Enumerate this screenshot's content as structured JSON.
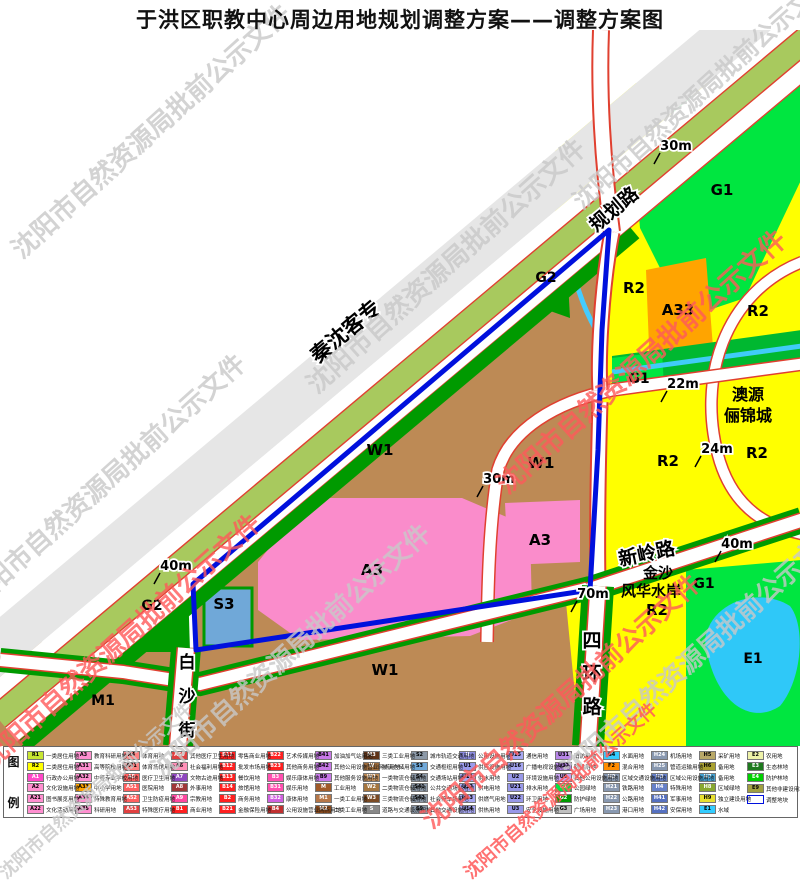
{
  "title": "于洪区职教中心周边用地规划调整方案——调整方案图",
  "watermark": {
    "text": "沈阳市自然资源局批前公示文件",
    "gray_color": "#c9c9c9",
    "red_color": "#ff5a5a",
    "instances": [
      {
        "x": 150,
        "y": 130,
        "color": "#c9c9c9",
        "size": 26,
        "opacity": 0.8
      },
      {
        "x": 445,
        "y": 265,
        "color": "#c9c9c9",
        "size": 26,
        "opacity": 0.8
      },
      {
        "x": 105,
        "y": 480,
        "color": "#c9c9c9",
        "size": 26,
        "opacity": 0.8
      },
      {
        "x": 290,
        "y": 650,
        "color": "#c9c9c9",
        "size": 26,
        "opacity": 0.8
      },
      {
        "x": 700,
        "y": 650,
        "color": "#c9c9c9",
        "size": 26,
        "opacity": 0.8
      },
      {
        "x": 700,
        "y": 90,
        "color": "#c9c9c9",
        "size": 24,
        "opacity": 0.8
      },
      {
        "x": 95,
        "y": 790,
        "color": "#c9c9c9",
        "size": 18,
        "opacity": 0.8
      },
      {
        "x": 640,
        "y": 360,
        "color": "#ff5a5a",
        "size": 27,
        "opacity": 0.8
      },
      {
        "x": 120,
        "y": 640,
        "color": "#ff5a5a",
        "size": 26,
        "opacity": 0.8
      },
      {
        "x": 560,
        "y": 700,
        "color": "#ff5a5a",
        "size": 26,
        "opacity": 0.8
      },
      {
        "x": 560,
        "y": 790,
        "color": "#ff5a5a",
        "size": 18,
        "opacity": 0.85
      }
    ]
  },
  "map": {
    "zone_colors": {
      "R2": "#ffff00",
      "W1": "#bd8a55",
      "A3": "#fa8ccb",
      "A33": "#ffa400",
      "G1": "#00e640",
      "G2": "#009a00",
      "S3": "#70a8d8",
      "E1": "#2fc8f8",
      "corridor_band": "#a8c95e",
      "road_edge": "#e04030",
      "boundary": "#0010dd"
    },
    "road_labels": [
      {
        "text": "规划路",
        "x": 618,
        "y": 184,
        "size": 19,
        "rot": -40,
        "outline": true
      },
      {
        "text": "秦沈客专",
        "x": 350,
        "y": 307,
        "size": 21,
        "rot": -40,
        "outline": true
      },
      {
        "text": "新岭路",
        "x": 648,
        "y": 530,
        "size": 19,
        "rot": -12,
        "outline": true
      },
      {
        "text": "四环路",
        "x": 592,
        "y": 617,
        "size": 19,
        "rot": 0,
        "outline": true,
        "vertical": true,
        "step": 33
      },
      {
        "text": "白沙街",
        "x": 187,
        "y": 638,
        "size": 17,
        "rot": 0,
        "outline": true,
        "vertical": true,
        "step": 34
      }
    ],
    "zone_labels": [
      {
        "text": "G1",
        "x": 722,
        "y": 165,
        "size": 15
      },
      {
        "text": "R2",
        "x": 634,
        "y": 263,
        "size": 15
      },
      {
        "text": "A33",
        "x": 678,
        "y": 285,
        "size": 15
      },
      {
        "text": "R2",
        "x": 758,
        "y": 286,
        "size": 15
      },
      {
        "text": "G2",
        "x": 546,
        "y": 252,
        "size": 14
      },
      {
        "text": "G1",
        "x": 639,
        "y": 353,
        "size": 14
      },
      {
        "text": "R2",
        "x": 668,
        "y": 436,
        "size": 15
      },
      {
        "text": "R2",
        "x": 757,
        "y": 428,
        "size": 15
      },
      {
        "text": "W1",
        "x": 380,
        "y": 425,
        "size": 15
      },
      {
        "text": "W1",
        "x": 541,
        "y": 438,
        "size": 15
      },
      {
        "text": "A3",
        "x": 372,
        "y": 545,
        "size": 15
      },
      {
        "text": "A3",
        "x": 540,
        "y": 515,
        "size": 15
      },
      {
        "text": "G2",
        "x": 152,
        "y": 580,
        "size": 14
      },
      {
        "text": "S3",
        "x": 224,
        "y": 579,
        "size": 15
      },
      {
        "text": "W1",
        "x": 385,
        "y": 645,
        "size": 15
      },
      {
        "text": "M1",
        "x": 103,
        "y": 675,
        "size": 14
      },
      {
        "text": "G1",
        "x": 704,
        "y": 558,
        "size": 14
      },
      {
        "text": "E1",
        "x": 753,
        "y": 633,
        "size": 14
      },
      {
        "text": "澳源",
        "x": 748,
        "y": 370,
        "size": 16
      },
      {
        "text": "俪锦城",
        "x": 748,
        "y": 391,
        "size": 16
      },
      {
        "text": "金沙",
        "x": 658,
        "y": 548,
        "size": 15
      },
      {
        "text": "风华水岸",
        "x": 651,
        "y": 566,
        "size": 15
      },
      {
        "text": "R2",
        "x": 657,
        "y": 585,
        "size": 15
      }
    ],
    "dimensions": [
      {
        "text": "30m",
        "x": 676,
        "y": 120
      },
      {
        "text": "22m",
        "x": 683,
        "y": 358
      },
      {
        "text": "24m",
        "x": 717,
        "y": 423
      },
      {
        "text": "40m",
        "x": 737,
        "y": 518
      },
      {
        "text": "70m",
        "x": 593,
        "y": 568
      },
      {
        "text": "30m",
        "x": 499,
        "y": 453
      },
      {
        "text": "40m",
        "x": 176,
        "y": 540
      }
    ]
  },
  "legend": {
    "header_chars": [
      "图",
      "例"
    ],
    "columns": [
      [
        {
          "code": "R1",
          "label": "一类居住用地",
          "color": "#c8e632"
        },
        {
          "code": "R2",
          "label": "二类居住用地",
          "color": "#ffff00"
        },
        {
          "code": "A1",
          "label": "行政办公用地",
          "color": "#ff48c8"
        },
        {
          "code": "A2",
          "label": "文化设施用地",
          "color": "#ff8fd0"
        },
        {
          "code": "A21",
          "label": "图书展览用地",
          "color": "#ff8fd0"
        },
        {
          "code": "A22",
          "label": "文化活动用地",
          "color": "#ff8fd0"
        }
      ],
      [
        {
          "code": "A3",
          "label": "教育科研用地",
          "color": "#ff8fd0"
        },
        {
          "code": "A31",
          "label": "高等院校用地",
          "color": "#ff8fd0"
        },
        {
          "code": "A32",
          "label": "中等专业学校用地",
          "color": "#ff8fd0"
        },
        {
          "code": "A33",
          "label": "中小学用地",
          "color": "#ffa400"
        },
        {
          "code": "A34",
          "label": "特殊教育用地",
          "color": "#ff8fd0"
        },
        {
          "code": "A35",
          "label": "科研用地",
          "color": "#ff8fd0"
        }
      ],
      [
        {
          "code": "A4",
          "label": "体育用地",
          "color": "#ff8080"
        },
        {
          "code": "A41",
          "label": "体育场馆用地",
          "color": "#ff8080"
        },
        {
          "code": "A5",
          "label": "医疗卫生用地",
          "color": "#ff6060"
        },
        {
          "code": "A51",
          "label": "医院用地",
          "color": "#ff6060"
        },
        {
          "code": "A52",
          "label": "卫生防疫用地",
          "color": "#ff6060"
        },
        {
          "code": "A53",
          "label": "特殊医疗用地",
          "color": "#e04040"
        }
      ],
      [
        {
          "code": "A59",
          "label": "其他医疗卫生用地",
          "color": "#e04040"
        },
        {
          "code": "A6",
          "label": "社会福利用地",
          "color": "#ff90b8"
        },
        {
          "code": "A7",
          "label": "文物古迹用地",
          "color": "#9048c0"
        },
        {
          "code": "A8",
          "label": "外事用地",
          "color": "#a03838"
        },
        {
          "code": "A9",
          "label": "宗教用地",
          "color": "#ff48a0"
        },
        {
          "code": "B1",
          "label": "商业用地",
          "color": "#ff2020"
        }
      ],
      [
        {
          "code": "B11",
          "label": "零售商业用地",
          "color": "#ff2020"
        },
        {
          "code": "B12",
          "label": "批发市场用地",
          "color": "#ff2020"
        },
        {
          "code": "B13",
          "label": "餐饮用地",
          "color": "#ff2020"
        },
        {
          "code": "B14",
          "label": "旅馆用地",
          "color": "#ff2020"
        },
        {
          "code": "B2",
          "label": "商务用地",
          "color": "#ff2020"
        },
        {
          "code": "B21",
          "label": "金融保险用地",
          "color": "#ff2020"
        }
      ],
      [
        {
          "code": "B22",
          "label": "艺术传媒用地",
          "color": "#ff2020"
        },
        {
          "code": "B23",
          "label": "其他商务用地",
          "color": "#ff2020"
        },
        {
          "code": "B3",
          "label": "娱乐康体用地",
          "color": "#ff50b0"
        },
        {
          "code": "B31",
          "label": "娱乐用地",
          "color": "#ff50b0"
        },
        {
          "code": "B32",
          "label": "康体用地",
          "color": "#d060e0"
        },
        {
          "code": "B4",
          "label": "公用设施营业网点用地",
          "color": "#c03030"
        }
      ],
      [
        {
          "code": "B41",
          "label": "加油加气站用地",
          "color": "#c878e8"
        },
        {
          "code": "B42",
          "label": "其他公用设施营业网点用地",
          "color": "#c878e8"
        },
        {
          "code": "B9",
          "label": "其他服务设施用地",
          "color": "#c878e8"
        },
        {
          "code": "M",
          "label": "工业用地",
          "color": "#a05a28"
        },
        {
          "code": "M1",
          "label": "一类工业用地",
          "color": "#b57648"
        },
        {
          "code": "M2",
          "label": "二类工业用地",
          "color": "#8a4a1c"
        }
      ],
      [
        {
          "code": "M3",
          "label": "三类工业用地",
          "color": "#5f3317"
        },
        {
          "code": "W",
          "label": "物流仓储用地",
          "color": "#9c6b3c"
        },
        {
          "code": "W1",
          "label": "一类物流仓储用地",
          "color": "#bd8a55"
        },
        {
          "code": "W2",
          "label": "二类物流仓储用地",
          "color": "#a5763f"
        },
        {
          "code": "W3",
          "label": "三类物流仓储用地",
          "color": "#7a4a24"
        },
        {
          "code": "S",
          "label": "道路与交通设施用地",
          "color": "#888888"
        }
      ],
      [
        {
          "code": "S2",
          "label": "城市轨道交通用地",
          "color": "#8c99a8"
        },
        {
          "code": "S3",
          "label": "交通枢纽用地",
          "color": "#70a8d8"
        },
        {
          "code": "S4",
          "label": "交通场站用地",
          "color": "#8c99a8"
        },
        {
          "code": "S41",
          "label": "公共交通场站用地",
          "color": "#8c99a8"
        },
        {
          "code": "S42",
          "label": "社会停车场用地",
          "color": "#8c99a8"
        },
        {
          "code": "S9",
          "label": "其他交通设施用地",
          "color": "#8c99a8"
        }
      ],
      [
        {
          "code": "U",
          "label": "公用设施用地",
          "color": "#8c8ce0"
        },
        {
          "code": "U1",
          "label": "供应设施用地",
          "color": "#9a9aec"
        },
        {
          "code": "U11",
          "label": "供水用地",
          "color": "#a6a6f2"
        },
        {
          "code": "U12",
          "label": "供电用地",
          "color": "#a6a6f2"
        },
        {
          "code": "U13",
          "label": "供燃气用地",
          "color": "#a6a6f2"
        },
        {
          "code": "U14",
          "label": "供热用地",
          "color": "#a6a6f2"
        }
      ],
      [
        {
          "code": "U15",
          "label": "通信用地",
          "color": "#a6a6f2"
        },
        {
          "code": "U16",
          "label": "广播电视设施用地",
          "color": "#a6a6f2"
        },
        {
          "code": "U2",
          "label": "环境设施用地",
          "color": "#9898e8"
        },
        {
          "code": "U21",
          "label": "排水用地",
          "color": "#9898e8"
        },
        {
          "code": "U22",
          "label": "环卫用地",
          "color": "#9898e8"
        },
        {
          "code": "U3",
          "label": "安全设施用地",
          "color": "#9898e8"
        }
      ],
      [
        {
          "code": "U31",
          "label": "消防用地",
          "color": "#b886e8"
        },
        {
          "code": "U32",
          "label": "防洪用地",
          "color": "#b886e8"
        },
        {
          "code": "U9",
          "label": "其他公用设施用地",
          "color": "#c8a2ee"
        },
        {
          "code": "G1",
          "label": "公园绿地",
          "color": "#00e640"
        },
        {
          "code": "G2",
          "label": "防护绿地",
          "color": "#009a00"
        },
        {
          "code": "G3",
          "label": "广场用地",
          "color": "#c0c0c0"
        }
      ],
      [
        {
          "code": "G4",
          "label": "水面用地",
          "color": "#33ccff"
        },
        {
          "code": "F2",
          "label": "混合用地",
          "color": "#ff8c00"
        },
        {
          "code": "H2",
          "label": "区域交通设施用地",
          "color": "#8898b0"
        },
        {
          "code": "H21",
          "label": "铁路用地",
          "color": "#8898b0"
        },
        {
          "code": "H22",
          "label": "公路用地",
          "color": "#8898b0"
        },
        {
          "code": "H23",
          "label": "港口用地",
          "color": "#8898b0"
        }
      ],
      [
        {
          "code": "H24",
          "label": "机场用地",
          "color": "#8898b0"
        },
        {
          "code": "H25",
          "label": "管道运输用地",
          "color": "#8898b0"
        },
        {
          "code": "H3",
          "label": "区域公用设施用地",
          "color": "#6680c8"
        },
        {
          "code": "H4",
          "label": "特殊用地",
          "color": "#6680c8"
        },
        {
          "code": "H41",
          "label": "军事用地",
          "color": "#5570c0"
        },
        {
          "code": "H42",
          "label": "安保用地",
          "color": "#5570c0"
        }
      ],
      [
        {
          "code": "H5",
          "label": "采矿用地",
          "color": "#b8a868"
        },
        {
          "code": "H6",
          "label": "备用地",
          "color": "#a8a030"
        },
        {
          "code": "H7",
          "label": "备用地",
          "color": "#44a0d0"
        },
        {
          "code": "H8",
          "label": "区域绿地",
          "color": "#88a830"
        },
        {
          "code": "H9",
          "label": "独立建设用地",
          "color": "#e8e030"
        },
        {
          "code": "E1",
          "label": "水域",
          "color": "#33ccff"
        }
      ],
      [
        {
          "code": "E2",
          "label": "农用地",
          "color": "#eef2a8"
        },
        {
          "code": "E3",
          "label": "生态林地",
          "color": "#1e7a1e"
        },
        {
          "code": "E4",
          "label": "防护林地",
          "color": "#00d000"
        },
        {
          "code": "E9",
          "label": "其他非建设用地",
          "color": "#a0a040"
        },
        {
          "code": "",
          "label": "调整地块",
          "color": "#ffffff",
          "border": "#0010dd"
        }
      ]
    ]
  }
}
